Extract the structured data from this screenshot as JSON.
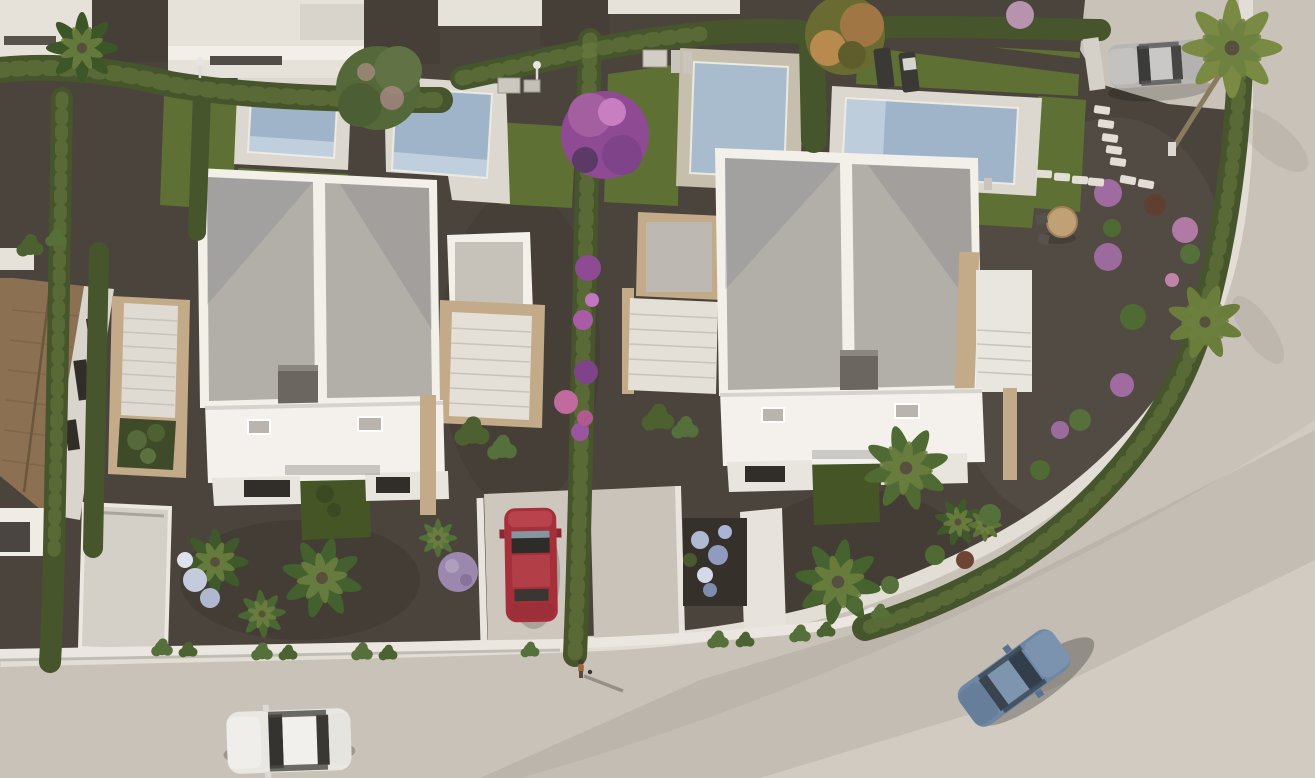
{
  "meta": {
    "description": "Aerial 3D architectural render of a new-build residential development: two modern white flat-roof villas with private pools, landscaped gardens, hedged plots, palm trees and a curving asphalt road with parked cars.",
    "width_px": 1315,
    "height_px": 778,
    "time_of_day": "warm low sunlight"
  },
  "colors": {
    "gravel": "#4b443c",
    "gravelLight": "#5a5248",
    "road": "#c9c2b9",
    "roadLight": "#dad4cb",
    "sidewalk": "#e2ddd5",
    "wallBright": "#ebe7e0",
    "wall": "#e6e2da",
    "lawn": "#5f7034",
    "lawnDark": "#465526",
    "hedge": "#46552c",
    "hedgeLight": "#6d7f42",
    "deck": "#ddd8cf",
    "deckWarm": "#c7bfae",
    "pool": "#9fb4c9",
    "pool2": "#a9bcce",
    "poolLight": "#c6d3e0",
    "roofGray": "#b2afa9",
    "villaWhite": "#f3f0ea",
    "terrace": "#f4f1ec",
    "facade": "#e8e4de",
    "tan": "#c3ab89",
    "chimney": "#6b6760",
    "window": "#312e29",
    "brick": "#8b7052",
    "drive": "#cdc7bd",
    "carRed": "#a63039",
    "carWhite": "#e9e7e2",
    "carBlue": "#6e87a2",
    "carSilver": "#b7b6b4",
    "palmDark": "#3f5a2a",
    "palmLight": "#6d8040",
    "purpleTree": "#8e4a92",
    "pinkFlower": "#c9889d",
    "flowerBlue": "#aebad4",
    "tableTan": "#c0a175"
  },
  "scene": {
    "villas": [
      {
        "label": "left villa",
        "features": [
          "flat gravel roof, two panels",
          "dark roof hatch box",
          "side staircases with tan stone rails",
          "white terrace with skylights",
          "front lawn with topiary"
        ]
      },
      {
        "label": "right villa",
        "features": [
          "flat gravel roof, two panels",
          "dark roof hatch box",
          "side staircases with tan stone rails",
          "white terrace with skylights",
          "large front palm"
        ]
      }
    ],
    "pools": [
      {
        "label": "pool far left",
        "orientation": "portrait"
      },
      {
        "label": "pool left of villa 1",
        "orientation": "portrait"
      },
      {
        "label": "pool behind villa 2",
        "orientation": "portrait"
      },
      {
        "label": "wide pool top right with two sun loungers",
        "orientation": "landscape"
      }
    ],
    "vehicles": [
      {
        "label": "white car",
        "location": "road bottom left"
      },
      {
        "label": "red car",
        "location": "driveway between villas"
      },
      {
        "label": "blue car",
        "location": "curving road bottom right"
      },
      {
        "label": "silver car",
        "location": "parking pad top right"
      }
    ],
    "other": [
      "pedestrian with long shadow on sidewalk",
      "round garden table with chairs",
      "stepping-stone paths",
      "bougainvillea and purple shrubs",
      "boundary hedges",
      "old tiled-roof house at left edge",
      "neighbouring white buildings along top edge"
    ]
  }
}
